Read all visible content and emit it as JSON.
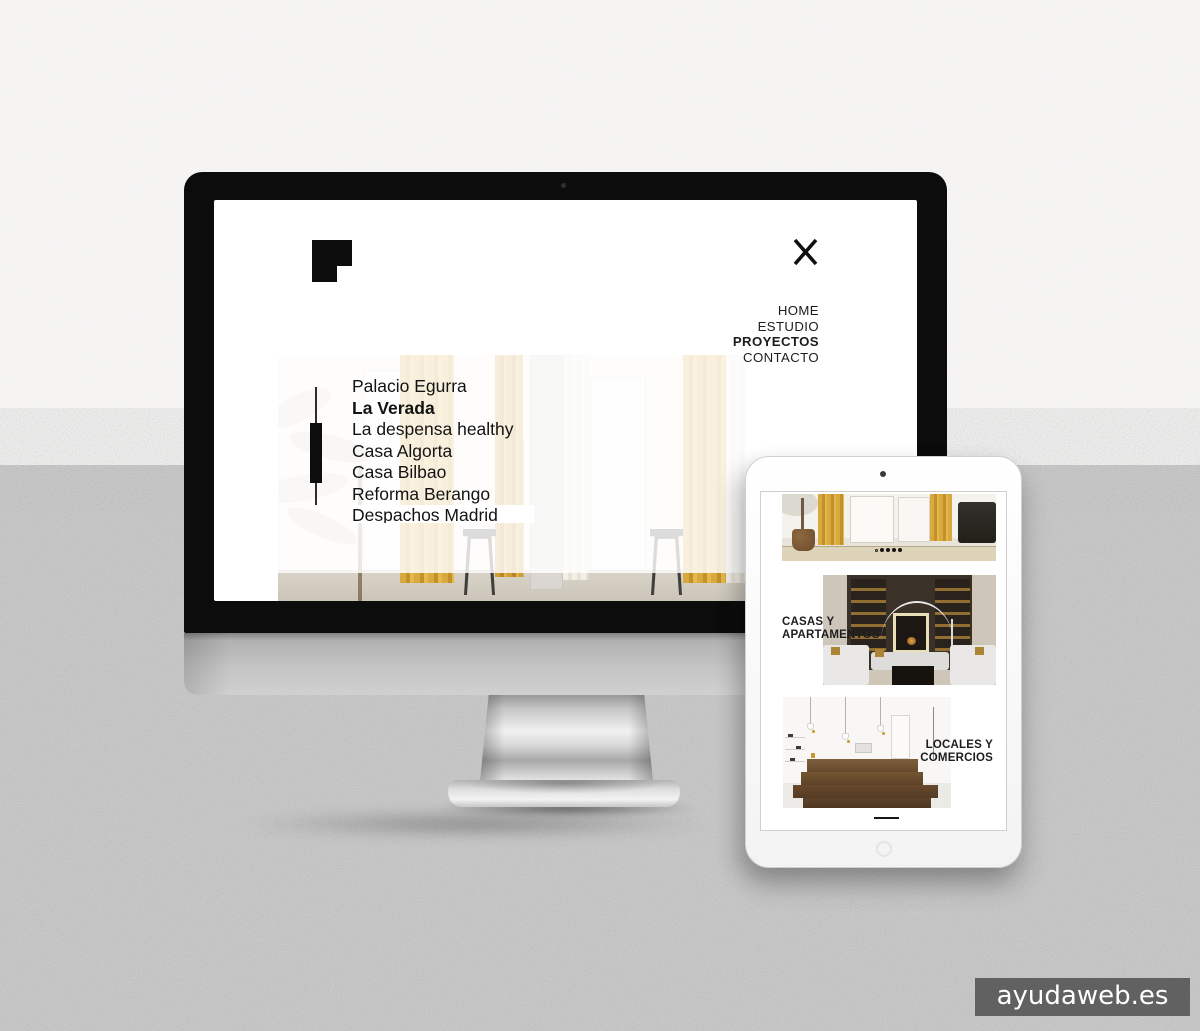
{
  "monitor_site": {
    "nav": {
      "items": [
        {
          "label": "HOME",
          "active": false
        },
        {
          "label": "ESTUDIO",
          "active": false
        },
        {
          "label": "PROYECTOS",
          "active": true
        },
        {
          "label": "CONTACTO",
          "active": false
        }
      ]
    },
    "projects": {
      "items": [
        {
          "label": "Palacio Egurra",
          "active": false
        },
        {
          "label": "La Verada",
          "active": true
        },
        {
          "label": "La despensa healthy",
          "active": false
        },
        {
          "label": "Casa Algorta",
          "active": false
        },
        {
          "label": "Casa Bilbao",
          "active": false
        },
        {
          "label": "Reforma Berango",
          "active": false
        },
        {
          "label": "Despachos Madrid",
          "active": false
        }
      ]
    }
  },
  "tablet_site": {
    "carousel": {
      "dot_count": 5,
      "active_dot_index": 0
    },
    "categories": [
      {
        "line1": "CASAS Y",
        "line2": "APARTAMENTOS"
      },
      {
        "line1": "LOCALES Y",
        "line2": "COMERCIOS"
      }
    ]
  },
  "watermark": {
    "label": "ayudaweb.es",
    "bg": "#5c5c5c"
  },
  "colors": {
    "curtain_yellow": "#d2a138",
    "wood_brown": "#6f5335",
    "dark_interior": "#383027",
    "page_top_bg": "#f8f7f6",
    "page_bottom_bg": "#c8c7c7"
  }
}
